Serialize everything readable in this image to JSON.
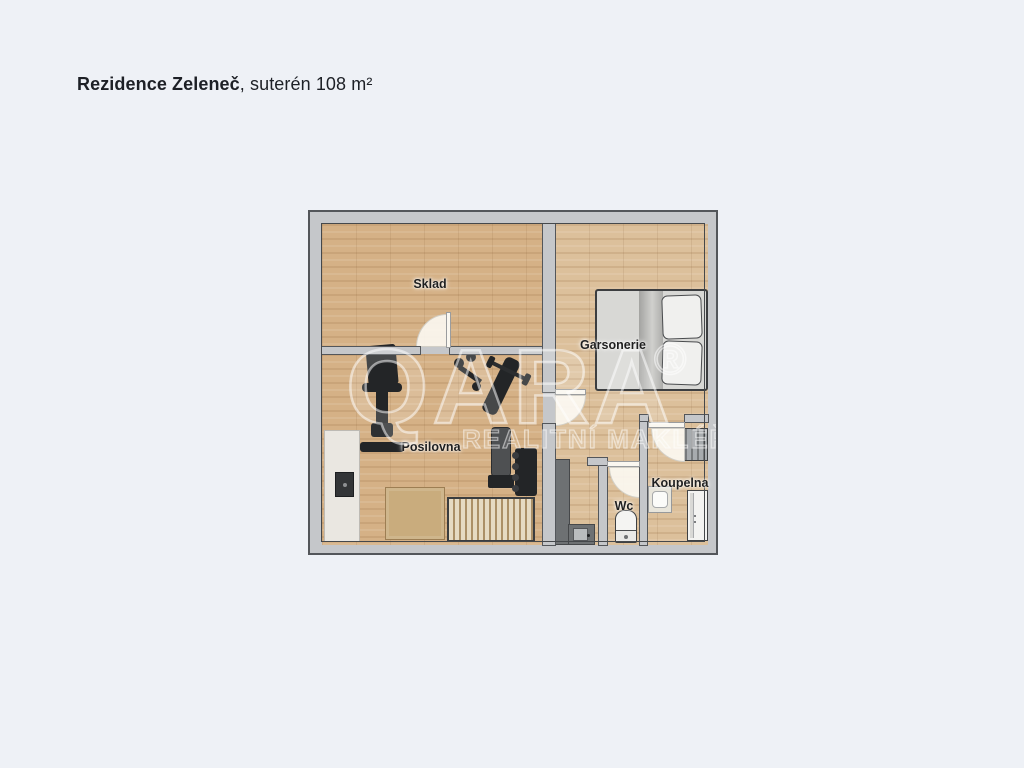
{
  "title": {
    "name": "Rezidence Zeleneč",
    "suffix": ", suterén 108 m²"
  },
  "watermark": {
    "brand": "QARA",
    "registered": "®",
    "tagline": "REALITNÍ MAKLÉŘ"
  },
  "rooms": {
    "sklad": "Sklad",
    "garsonerie": "Garsonerie",
    "posilovna": "Posilovna",
    "wc": "Wc",
    "koupelna": "Koupelna"
  },
  "colors": {
    "page_bg": "#eef1f6",
    "wall": "#c5c7ca",
    "wall_line": "#53565a",
    "wood": "#d5b186",
    "wood_light": "#dcc09b",
    "door": "#faf7f0",
    "mat": "#c9ac7d",
    "counter": "#6e7173",
    "equipment_dark": "#232527",
    "bed_gray": "#d8d8d5"
  }
}
